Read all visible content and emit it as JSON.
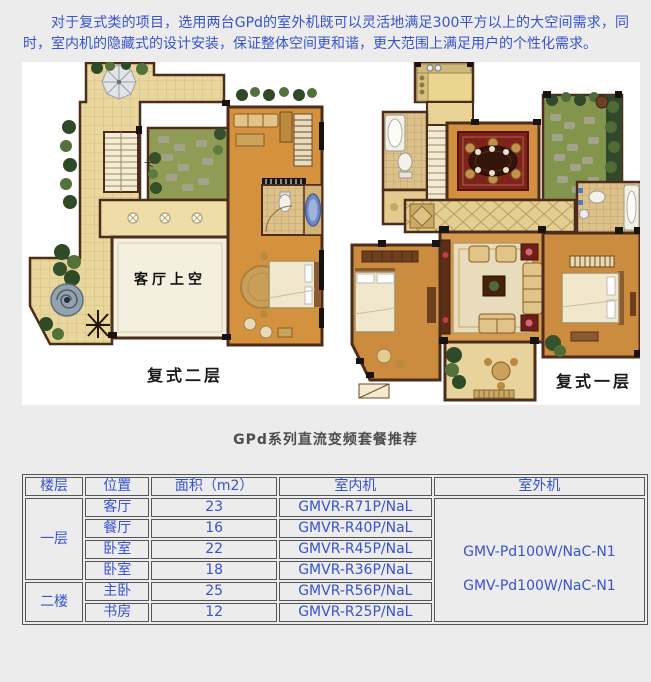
{
  "page": {
    "intro": "对于复式类的项目，选用两台GPd的室外机既可以灵活地满足300平方以上的大空间需求，同时，室内机的隐藏式的设计安装，保证整体空间更和谐，更大范围上满足用户的个性化需求。",
    "section_title": "GPd系列直流变频套餐推荐"
  },
  "floorplans": {
    "upper": {
      "caption": "复式二层",
      "void_label": "客厅上空",
      "stair_label": "下"
    },
    "lower": {
      "caption": "复式一层"
    }
  },
  "table": {
    "headers": [
      "楼层",
      "位置",
      "面积（m2）",
      "室内机",
      "室外机"
    ],
    "floors": [
      {
        "floor": "一层",
        "rows": [
          {
            "location": "客厅",
            "area": "23",
            "indoor": "GMVR-R71P/NaL"
          },
          {
            "location": "餐厅",
            "area": "16",
            "indoor": "GMVR-R40P/NaL"
          },
          {
            "location": "卧室",
            "area": "22",
            "indoor": "GMVR-R45P/NaL"
          },
          {
            "location": "卧室",
            "area": "18",
            "indoor": "GMVR-R36P/NaL"
          }
        ]
      },
      {
        "floor": "二楼",
        "rows": [
          {
            "location": "主卧",
            "area": "25",
            "indoor": "GMVR-R56P/NaL"
          },
          {
            "location": "书房",
            "area": "12",
            "indoor": "GMVR-R25P/NaL"
          }
        ]
      }
    ],
    "outdoor_units": [
      "GMV-Pd100W/NaC-N1",
      "GMV-Pd100W/NaC-N1"
    ]
  },
  "colors": {
    "text_blue": "#3753cf",
    "page_bg": "#ececec",
    "wall_brown": "#4e2c1b",
    "floor_orange": "#d3913e",
    "terrace_tan": "#e9d79e"
  }
}
